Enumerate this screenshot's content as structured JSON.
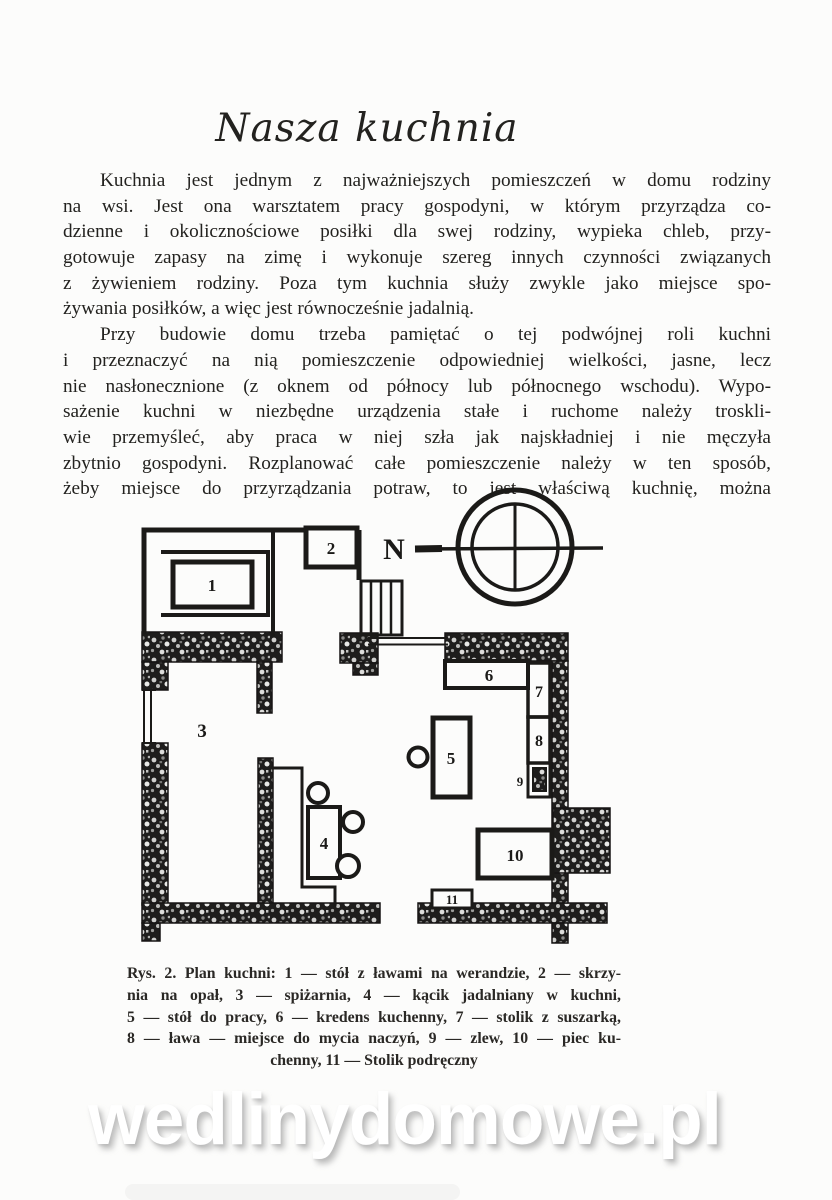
{
  "page": {
    "title": "Nasza kuchnia",
    "watermark": "wedlinydomowe.pl"
  },
  "body": {
    "paragraphs": [
      {
        "lines": [
          "Kuchnia jest jednym z najważniejszych pomieszczeń w domu rodziny",
          "na wsi. Jest ona warsztatem pracy gospodyni, w którym przyrządza co-",
          "dzienne i okolicznościowe posiłki dla swej rodziny, wypieka chleb, przy-",
          "gotowuje zapasy na zimę i wykonuje szereg innych czynności związanych",
          "z żywieniem rodziny. Poza tym kuchnia służy zwykle jako miejsce spo-",
          "żywania posiłków, a więc jest równocześnie jadalnią."
        ]
      },
      {
        "lines": [
          "Przy budowie domu trzeba pamiętać o tej podwójnej roli kuchni",
          "i przeznaczyć na nią pomieszczenie odpowiedniej wielkości, jasne, lecz",
          "nie nasłonecznione (z oknem od północy lub północnego wschodu). Wypo-",
          "sażenie kuchni w niezbędne urządzenia stałe i ruchome należy troskli-",
          "wie przemyśleć, aby praca w niej szła jak najskładniej i nie męczyła",
          "zbytnio gospodyni. Rozplanować całe pomieszczenie należy w ten sposób,",
          "żeby miejsce do przyrządzania potraw, to jest właściwą kuchnię, można"
        ]
      }
    ]
  },
  "figure": {
    "compass_label": "N",
    "plan_labels": {
      "l1": "1",
      "l2": "2",
      "l3": "3",
      "l4": "4",
      "l5": "5",
      "l6": "6",
      "l7": "7",
      "l8": "8",
      "l9": "9",
      "l10": "10",
      "l11": "11"
    },
    "caption_lines": [
      "Rys. 2. Plan kuchni: 1 — stół z ławami na werandzie, 2 — skrzy-",
      "nia na opał, 3 — spiżarnia, 4 — kącik jadalniany w kuchni,",
      "5 — stół do pracy, 6 — kredens kuchenny, 7 — stolik z suszarką,",
      "8 — ława — miejsce do mycia naczyń, 9 — zlew, 10 — piec ku-",
      "chenny, 11 — Stolik podręczny"
    ]
  }
}
